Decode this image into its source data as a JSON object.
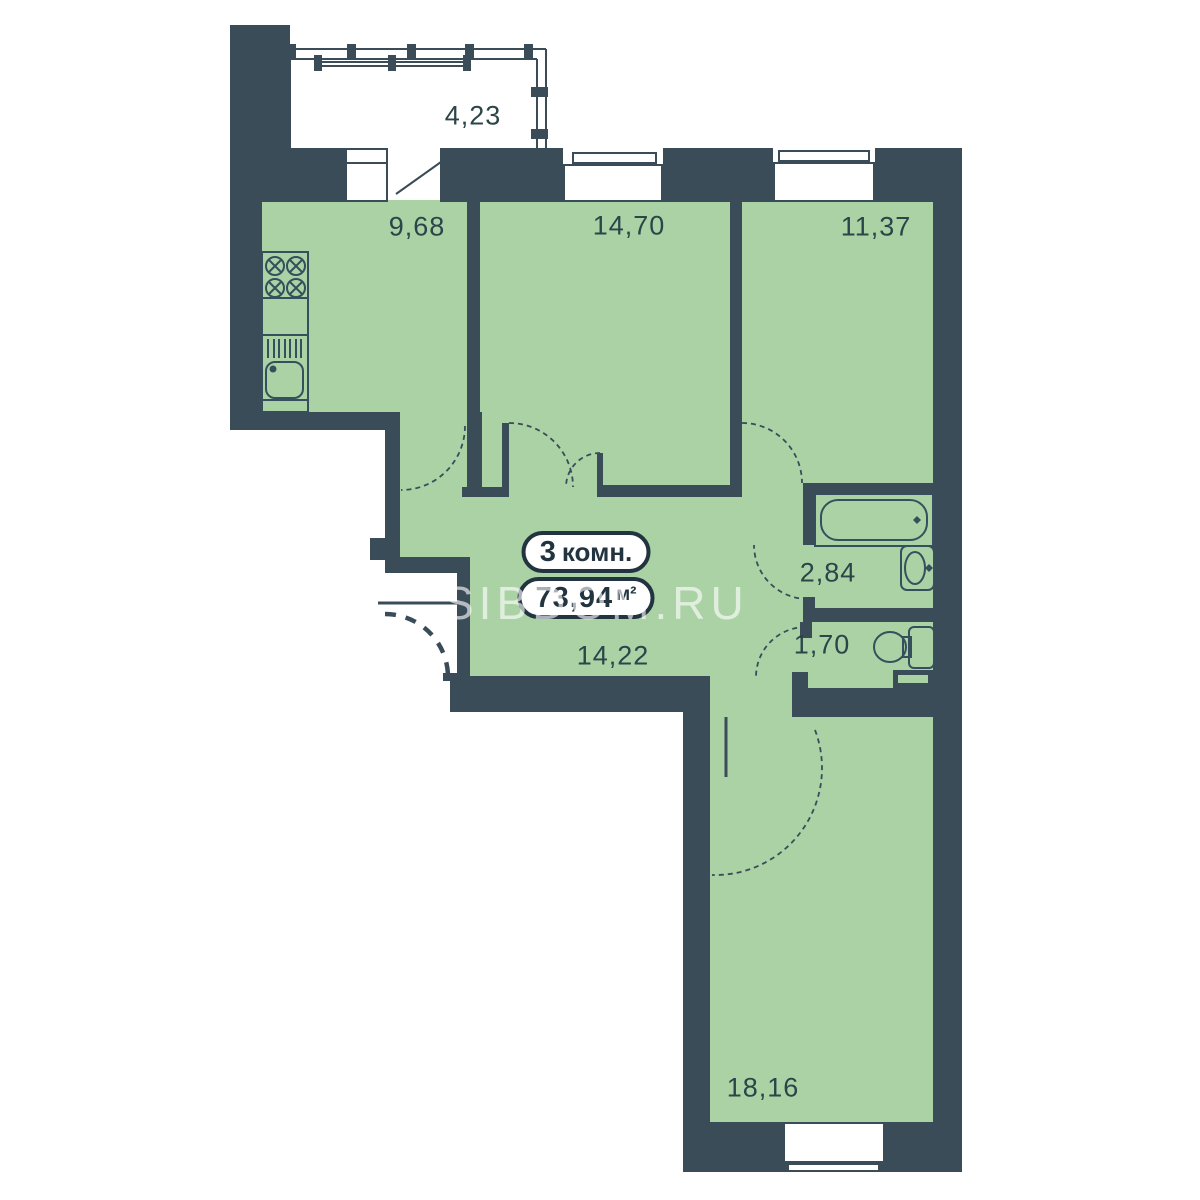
{
  "plan_title": "apartment-floor-plan",
  "badge": {
    "rooms_count": "3",
    "rooms_label": "комн.",
    "area_value": "73,94",
    "area_unit": "м²"
  },
  "rooms": {
    "balcony": {
      "area": "4,23"
    },
    "kitchen": {
      "area": "9,68"
    },
    "bedroom_mid": {
      "area": "14,70"
    },
    "bedroom_right": {
      "area": "11,37"
    },
    "bathroom": {
      "area": "2,84"
    },
    "wc": {
      "area": "1,70"
    },
    "hallway": {
      "area": "14,22"
    },
    "living_room": {
      "area": "18,16"
    }
  },
  "watermark": {
    "text": "SIBDOM.RU"
  },
  "fixtures": [
    "stove",
    "kitchen-sink",
    "bathtub",
    "washbasin",
    "toilet",
    "balcony-glazing"
  ],
  "colors": {
    "wall": "#3b4c59",
    "room_fill": "#aad2a5",
    "label_text": "#2b4549",
    "badge_outline": "#22343f",
    "watermark": "rgba(255,255,255,0.62)"
  }
}
